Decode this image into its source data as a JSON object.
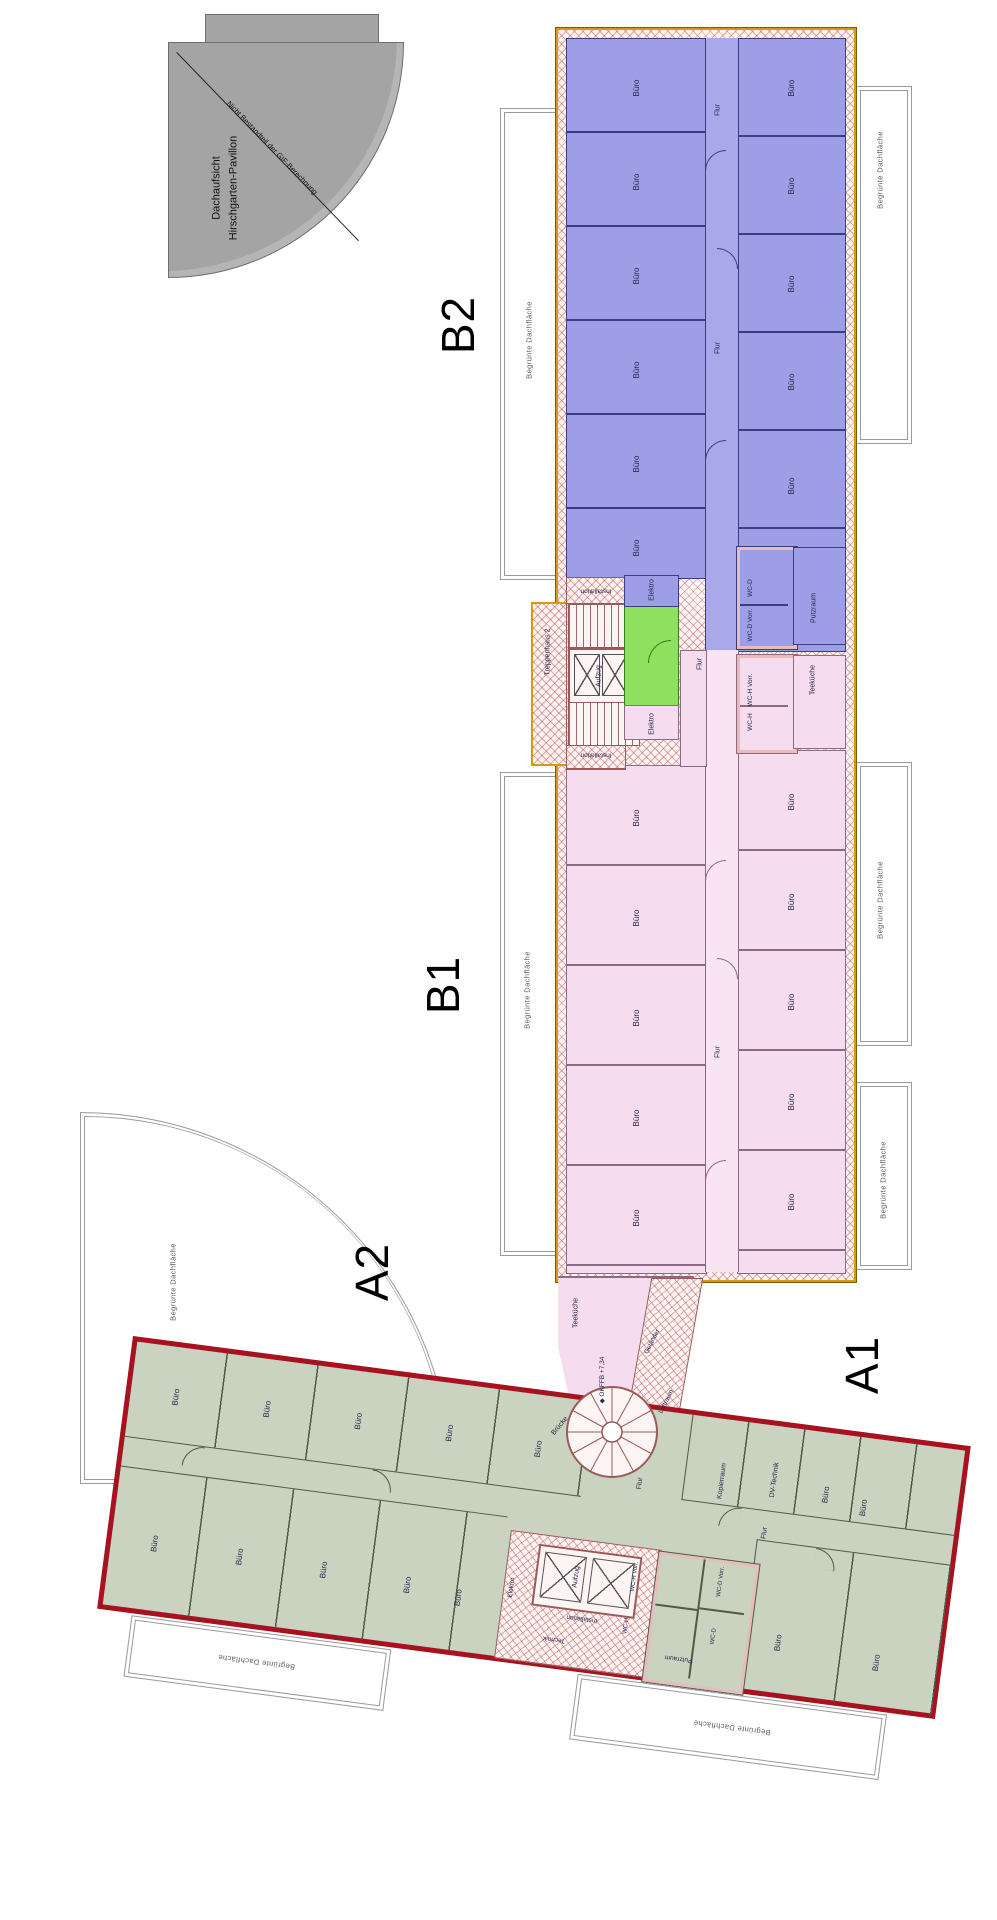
{
  "palette": {
    "b2_fill": "#9e9ee6",
    "b2_wall": "#3c3c80",
    "b1_fill": "#f6dcef",
    "b1_wall": "#8a6a85",
    "a_fill": "#c9d3bf",
    "a_wall": "#4f5a49",
    "a_border": "#a81220",
    "strip_border": "#d89a10",
    "core_green": "#8ee05e",
    "hatch_red": "#c05555",
    "pavilion_gray": "#a4a4a4",
    "terrace_line": "#9a9a9a"
  },
  "pavilion": {
    "title_line1": "Dachaufsicht",
    "title_line2": "Hirschgarten-Pavillon",
    "annotation": "Nicht Bestandteil der GIF-Berechnung"
  },
  "watermark": {
    "letter": "G",
    "fragment": "ilien"
  },
  "labels": {
    "page": [
      {
        "n": "pavilion-title-line1",
        "t": "Dachaufsicht",
        "x": 217,
        "y": 188,
        "r": -90,
        "s": 11,
        "c": "pav"
      },
      {
        "n": "pavilion-title-line2",
        "t": "Hirschgarten-Pavillon",
        "x": 234,
        "y": 188,
        "r": -90,
        "s": 11,
        "c": "pav"
      },
      {
        "n": "pavilion-annotation",
        "t": "Nicht Bestandteil der GIF-Berechnung",
        "x": 272,
        "y": 148,
        "r": 46,
        "s": 7.5,
        "c": "pav"
      },
      {
        "n": "watermark-letter",
        "t": "G",
        "x": 640,
        "y": 910,
        "r": 0,
        "s": 175,
        "c": "wm"
      },
      {
        "n": "watermark-fragment",
        "t": "ilien",
        "x": 640,
        "y": 1062,
        "r": 0,
        "s": 88,
        "c": "wm"
      },
      {
        "n": "section-label-b2",
        "t": "B2",
        "x": 458,
        "y": 325,
        "r": -90,
        "s": 46,
        "c": "big"
      },
      {
        "n": "section-label-b1",
        "t": "B1",
        "x": 443,
        "y": 985,
        "r": -90,
        "s": 46,
        "c": "big"
      },
      {
        "n": "section-label-a2",
        "t": "A2",
        "x": 372,
        "y": 1272,
        "r": -90,
        "s": 46,
        "c": "big"
      },
      {
        "n": "section-label-a1",
        "t": "A1",
        "x": 862,
        "y": 1365,
        "r": -90,
        "s": 46,
        "c": "big"
      },
      {
        "n": "roof-label-left-1",
        "t": "Begrünte Dachfläche",
        "x": 529,
        "y": 340,
        "r": -90,
        "s": 7.5,
        "c": "roof"
      },
      {
        "n": "roof-label-left-2",
        "t": "Begrünte Dachfläche",
        "x": 527,
        "y": 990,
        "r": -90,
        "s": 7.5,
        "c": "roof"
      },
      {
        "n": "roof-label-right-1",
        "t": "Begrünte Dachfläche",
        "x": 880,
        "y": 170,
        "r": -90,
        "s": 7.5,
        "c": "roof"
      },
      {
        "n": "roof-label-right-2",
        "t": "Begrünte Dachfläche",
        "x": 880,
        "y": 900,
        "r": -90,
        "s": 7.5,
        "c": "roof"
      },
      {
        "n": "roof-label-right-3",
        "t": "Begrünte Dachfläche",
        "x": 883,
        "y": 1180,
        "r": -90,
        "s": 7.5,
        "c": "roof"
      },
      {
        "n": "roof-label-arc",
        "t": "Begrünte Dachfläche",
        "x": 173,
        "y": 1282,
        "r": -90,
        "s": 7.5,
        "c": "roof"
      },
      {
        "n": "room-label-buero",
        "t": "Büro",
        "x": 637,
        "y": 88,
        "r": -90,
        "s": 8
      },
      {
        "n": "room-label-buero",
        "t": "Büro",
        "x": 637,
        "y": 182,
        "r": -90,
        "s": 8
      },
      {
        "n": "room-label-buero",
        "t": "Büro",
        "x": 637,
        "y": 276,
        "r": -90,
        "s": 8
      },
      {
        "n": "room-label-buero",
        "t": "Büro",
        "x": 637,
        "y": 370,
        "r": -90,
        "s": 8
      },
      {
        "n": "room-label-buero",
        "t": "Büro",
        "x": 637,
        "y": 464,
        "r": -90,
        "s": 8
      },
      {
        "n": "room-label-buero",
        "t": "Büro",
        "x": 637,
        "y": 548,
        "r": -90,
        "s": 8
      },
      {
        "n": "room-label-buero",
        "t": "Büro",
        "x": 792,
        "y": 88,
        "r": -90,
        "s": 8
      },
      {
        "n": "room-label-buero",
        "t": "Büro",
        "x": 792,
        "y": 186,
        "r": -90,
        "s": 8
      },
      {
        "n": "room-label-buero",
        "t": "Büro",
        "x": 792,
        "y": 284,
        "r": -90,
        "s": 8
      },
      {
        "n": "room-label-buero",
        "t": "Büro",
        "x": 792,
        "y": 382,
        "r": -90,
        "s": 8
      },
      {
        "n": "room-label-buero",
        "t": "Büro",
        "x": 792,
        "y": 486,
        "r": -90,
        "s": 8
      },
      {
        "n": "room-label-flur",
        "t": "Flur",
        "x": 718,
        "y": 110,
        "r": -90,
        "s": 7
      },
      {
        "n": "room-label-flur",
        "t": "Flur",
        "x": 718,
        "y": 348,
        "r": -90,
        "s": 7
      },
      {
        "n": "room-label-wc-d",
        "t": "WC-D",
        "x": 751,
        "y": 588,
        "r": -90,
        "s": 6.5
      },
      {
        "n": "room-label-wc-d-vorr",
        "t": "WC-D Vorr.",
        "x": 751,
        "y": 625,
        "r": -90,
        "s": 6.5
      },
      {
        "n": "room-label-putzraum",
        "t": "Putzraum",
        "x": 814,
        "y": 608,
        "r": -90,
        "s": 7
      },
      {
        "n": "room-label-elektro",
        "t": "Elektro",
        "x": 652,
        "y": 590,
        "r": -90,
        "s": 7
      },
      {
        "n": "room-label-installation",
        "t": "Installation",
        "x": 596,
        "y": 590,
        "r": 180,
        "s": 6.5
      },
      {
        "n": "room-label-treppenhaus-2",
        "t": "Treppenhaus 2",
        "x": 548,
        "y": 652,
        "r": -90,
        "s": 7
      },
      {
        "n": "room-label-aufzug",
        "t": "Aufzug",
        "x": 599,
        "y": 676,
        "r": -90,
        "s": 7
      },
      {
        "n": "room-label-installation",
        "t": "Installation",
        "x": 596,
        "y": 754,
        "r": 180,
        "s": 6.5
      },
      {
        "n": "room-label-elektro",
        "t": "Elektro",
        "x": 652,
        "y": 724,
        "r": -90,
        "s": 7
      },
      {
        "n": "room-label-flur",
        "t": "Flur",
        "x": 700,
        "y": 664,
        "r": -90,
        "s": 7
      },
      {
        "n": "room-label-flur",
        "t": "Flur",
        "x": 718,
        "y": 1052,
        "r": -90,
        "s": 7
      },
      {
        "n": "room-label-wc-h-vorr",
        "t": "WC-H Vorr.",
        "x": 751,
        "y": 690,
        "r": -90,
        "s": 6.5
      },
      {
        "n": "room-label-wc-h",
        "t": "WC-H",
        "x": 751,
        "y": 722,
        "r": -90,
        "s": 6.5
      },
      {
        "n": "room-label-teekueche",
        "t": "Teeküche",
        "x": 813,
        "y": 680,
        "r": -90,
        "s": 7
      },
      {
        "n": "room-label-buero",
        "t": "Büro",
        "x": 637,
        "y": 818,
        "r": -90,
        "s": 8
      },
      {
        "n": "room-label-buero",
        "t": "Büro",
        "x": 637,
        "y": 918,
        "r": -90,
        "s": 8
      },
      {
        "n": "room-label-buero",
        "t": "Büro",
        "x": 637,
        "y": 1018,
        "r": -90,
        "s": 8
      },
      {
        "n": "room-label-buero",
        "t": "Büro",
        "x": 637,
        "y": 1118,
        "r": -90,
        "s": 8
      },
      {
        "n": "room-label-buero",
        "t": "Büro",
        "x": 637,
        "y": 1218,
        "r": -90,
        "s": 8
      },
      {
        "n": "room-label-buero",
        "t": "Büro",
        "x": 792,
        "y": 802,
        "r": -90,
        "s": 8
      },
      {
        "n": "room-label-buero",
        "t": "Büro",
        "x": 792,
        "y": 902,
        "r": -90,
        "s": 8
      },
      {
        "n": "room-label-buero",
        "t": "Büro",
        "x": 792,
        "y": 1002,
        "r": -90,
        "s": 8
      },
      {
        "n": "room-label-buero",
        "t": "Büro",
        "x": 792,
        "y": 1102,
        "r": -90,
        "s": 8
      },
      {
        "n": "room-label-buero",
        "t": "Büro",
        "x": 792,
        "y": 1202,
        "r": -90,
        "s": 8
      },
      {
        "n": "room-label-teekueche",
        "t": "Teeküche",
        "x": 576,
        "y": 1313,
        "r": -90,
        "s": 7
      },
      {
        "n": "level-marker-okffb",
        "t": "◆ OKFFB +7,34",
        "x": 603,
        "y": 1380,
        "r": -90,
        "s": 6.5
      },
      {
        "n": "room-label-gelaender",
        "t": "Geländer",
        "x": 653,
        "y": 1342,
        "r": -63,
        "s": 6.5
      },
      {
        "n": "room-label-luftraum",
        "t": "Luftraum",
        "x": 667,
        "y": 1402,
        "r": -63,
        "s": 6.5
      },
      {
        "n": "room-label-bruecke",
        "t": "Brücke",
        "x": 560,
        "y": 1426,
        "r": -50,
        "s": 7
      }
    ],
    "building_a": [
      {
        "n": "room-label-buero",
        "t": "Büro",
        "x": 46,
        "y": 50,
        "r": -90,
        "s": 8
      },
      {
        "n": "room-label-buero",
        "t": "Büro",
        "x": 138,
        "y": 50,
        "r": -90,
        "s": 8
      },
      {
        "n": "room-label-buero",
        "t": "Büro",
        "x": 230,
        "y": 50,
        "r": -90,
        "s": 8
      },
      {
        "n": "room-label-buero",
        "t": "Büro",
        "x": 322,
        "y": 50,
        "r": -90,
        "s": 8
      },
      {
        "n": "room-label-buero",
        "t": "Büro",
        "x": 412,
        "y": 54,
        "r": -90,
        "s": 8
      },
      {
        "n": "room-label-treppenhaus-1",
        "t": "Treppenhaus 1",
        "x": 467,
        "y": 30,
        "r": -90,
        "s": 5.5
      },
      {
        "n": "room-label-flur",
        "t": "Flur",
        "x": 517,
        "y": 75,
        "r": -90,
        "s": 7
      },
      {
        "n": "room-label-kopierraum",
        "t": "Kopierraum",
        "x": 598,
        "y": 62,
        "r": -90,
        "s": 7
      },
      {
        "n": "room-label-dv-technik",
        "t": "DV-Technik",
        "x": 650,
        "y": 54,
        "r": -90,
        "s": 7
      },
      {
        "n": "room-label-buero",
        "t": "Büro",
        "x": 703,
        "y": 62,
        "r": -90,
        "s": 8
      },
      {
        "n": "room-label-buero",
        "t": "Büro",
        "x": 742,
        "y": 70,
        "r": -90,
        "s": 8
      },
      {
        "n": "room-label-buero",
        "t": "Büro",
        "x": 44,
        "y": 198,
        "r": -90,
        "s": 8
      },
      {
        "n": "room-label-buero",
        "t": "Büro",
        "x": 130,
        "y": 200,
        "r": -90,
        "s": 8
      },
      {
        "n": "room-label-buero",
        "t": "Büro",
        "x": 215,
        "y": 202,
        "r": -90,
        "s": 8
      },
      {
        "n": "room-label-buero",
        "t": "Büro",
        "x": 300,
        "y": 206,
        "r": -90,
        "s": 8
      },
      {
        "n": "room-label-buero",
        "t": "Büro",
        "x": 352,
        "y": 212,
        "r": -90,
        "s": 8
      },
      {
        "n": "room-label-elektro",
        "t": "Elektro",
        "x": 404,
        "y": 195,
        "r": -90,
        "s": 6.5
      },
      {
        "n": "room-label-aufzug",
        "t": "Aufzug",
        "x": 466,
        "y": 176,
        "r": -90,
        "s": 7
      },
      {
        "n": "room-label-installation",
        "t": "Installation",
        "x": 477,
        "y": 216,
        "r": 180,
        "s": 6.5
      },
      {
        "n": "room-label-technik",
        "t": "Technik",
        "x": 452,
        "y": 240,
        "r": 180,
        "s": 6.5
      },
      {
        "n": "room-label-wc-h-vorr",
        "t": "WC-H Vorr.",
        "x": 524,
        "y": 168,
        "r": -90,
        "s": 6
      },
      {
        "n": "room-label-wc-h",
        "t": "WC-H",
        "x": 522,
        "y": 218,
        "r": -90,
        "s": 6
      },
      {
        "n": "room-label-wc-d-vorr",
        "t": "WC-D Vorr.",
        "x": 610,
        "y": 162,
        "r": -90,
        "s": 6
      },
      {
        "n": "room-label-wc-d",
        "t": "WC-D",
        "x": 610,
        "y": 217,
        "r": -90,
        "s": 6
      },
      {
        "n": "room-label-putzraum",
        "t": "Putzraum",
        "x": 578,
        "y": 243,
        "r": 180,
        "s": 6.5
      },
      {
        "n": "room-label-flur",
        "t": "Flur",
        "x": 647,
        "y": 108,
        "r": -90,
        "s": 7
      },
      {
        "n": "room-label-buero",
        "t": "Büro",
        "x": 675,
        "y": 215,
        "r": -90,
        "s": 8
      },
      {
        "n": "room-label-buero",
        "t": "Büro",
        "x": 775,
        "y": 222,
        "r": -90,
        "s": 8
      },
      {
        "n": "roof-label-a-bottom-1",
        "t": "Begrünte Dachfläche",
        "x": 160,
        "y": 302,
        "r": 180,
        "s": 7.5,
        "c": "roof"
      },
      {
        "n": "roof-label-a-bottom-2",
        "t": "Begrünte Dachfläche",
        "x": 640,
        "y": 305,
        "r": 180,
        "s": 7.5,
        "c": "roof"
      }
    ]
  }
}
